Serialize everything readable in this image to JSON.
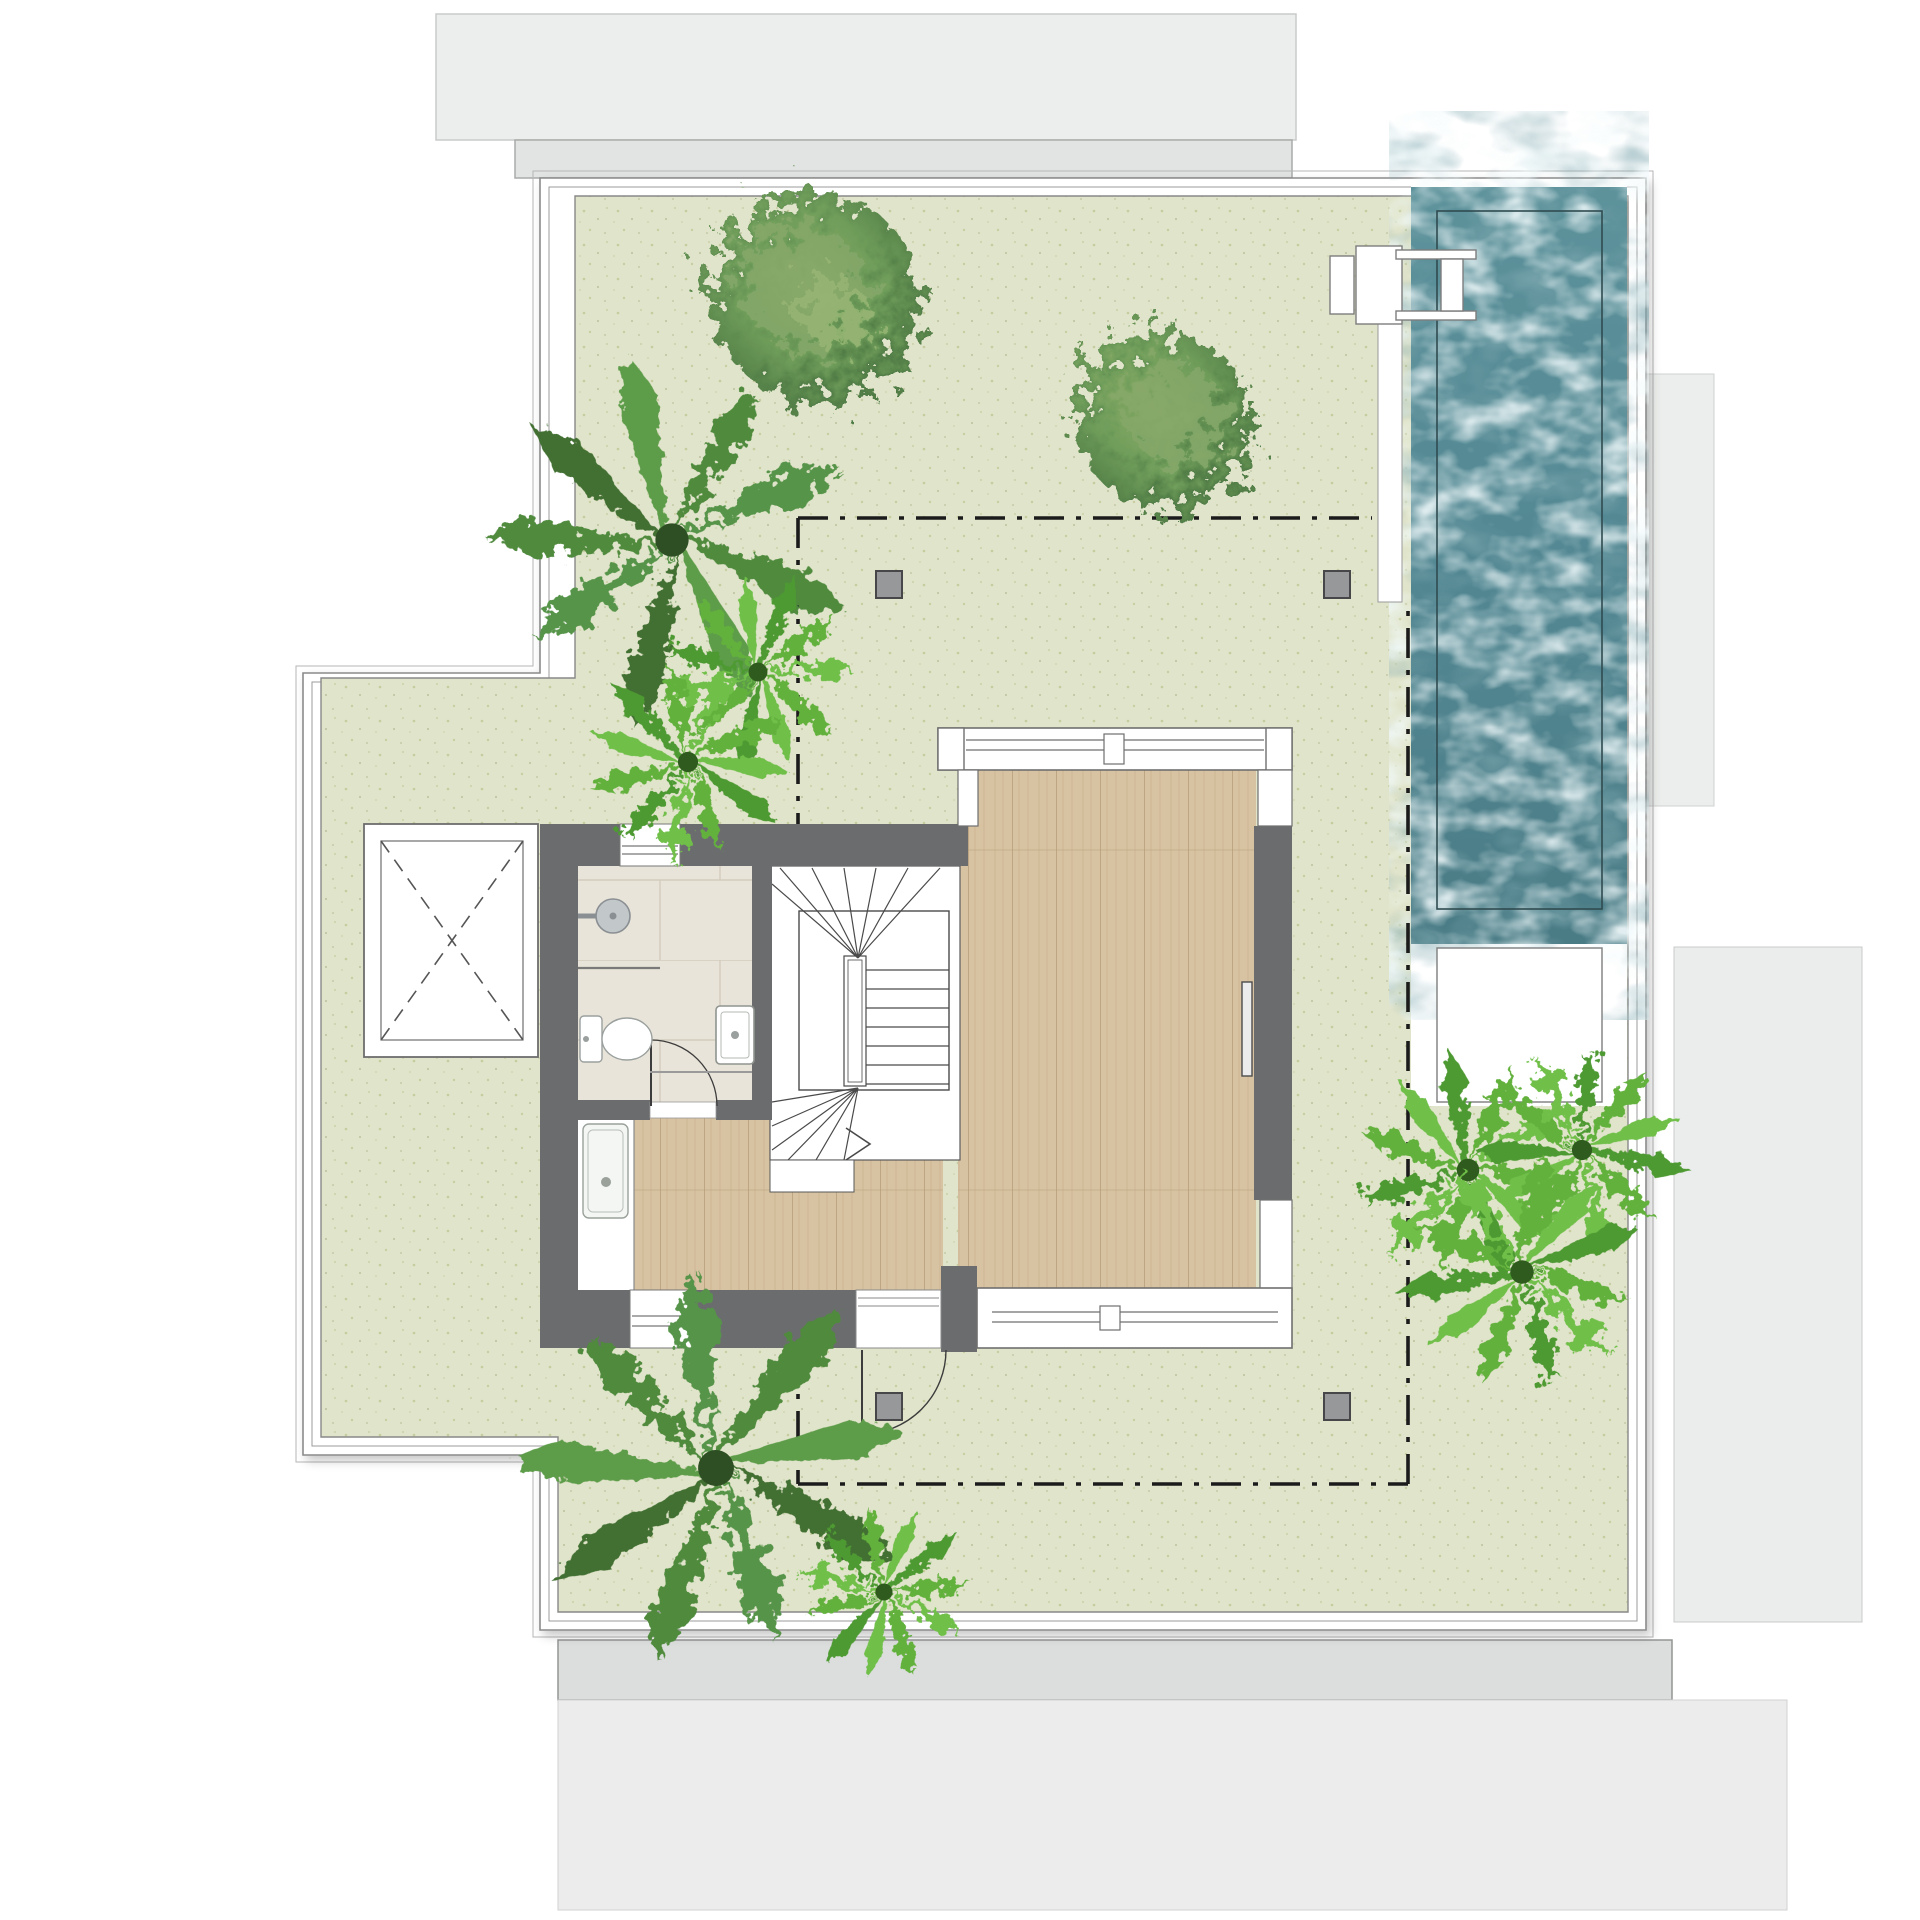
{
  "plan": {
    "type": "architectural-floor-plan",
    "level": "roof-terrace",
    "description": "Roof terrace floor plan: speckled green terrace deck with palm trees and bushes, long swimming pool at top right with ladder, central penthouse volume with wood-floor living room, winder staircase, tiled bathroom with shower, toilet and basins, elevator shaft marked with dashed X, dash-dot pergola outline with four gray columns, surrounded by light gray neighbouring roof slabs.",
    "rooms": [
      "terrace",
      "swimming-pool",
      "living-room",
      "stairwell",
      "bathroom",
      "hallway",
      "elevator-shaft"
    ],
    "features": {
      "pergola_columns": 4,
      "bush_trees": 2,
      "large_palms": 2,
      "fern_palms": 6,
      "exterior_doors": 1,
      "interior_doors": 1,
      "windows": 2,
      "pool_ladder": 1
    },
    "colors": {
      "background": "#ffffff",
      "neighbor_roof_light": "#eceeed",
      "neighbor_roof_mid": "#e2e4e3",
      "neighbor_roof_band": "#dcdedd",
      "terrace_green": "#e0e4ca",
      "terrace_speckle": "#aab472",
      "frame_line": "#8a8a8a",
      "wall_dark": "#6b6c6e",
      "column_gray": "#97989a",
      "pergola_dash": "#1b1b1b",
      "wood_floor": "#d7c2a2",
      "wood_grain": "#c3a988",
      "bathroom_tile": "#e9e4d9",
      "tile_joint": "#d3ccbd",
      "water_base": "#578a92",
      "water_deep": "#44727b",
      "water_ripple": "#e2f3f5",
      "fixture_white": "#ffffff",
      "bush_green": "#6f9d5a",
      "palm_green": "#4f8a3d",
      "fern_green": "#63b13e"
    }
  }
}
